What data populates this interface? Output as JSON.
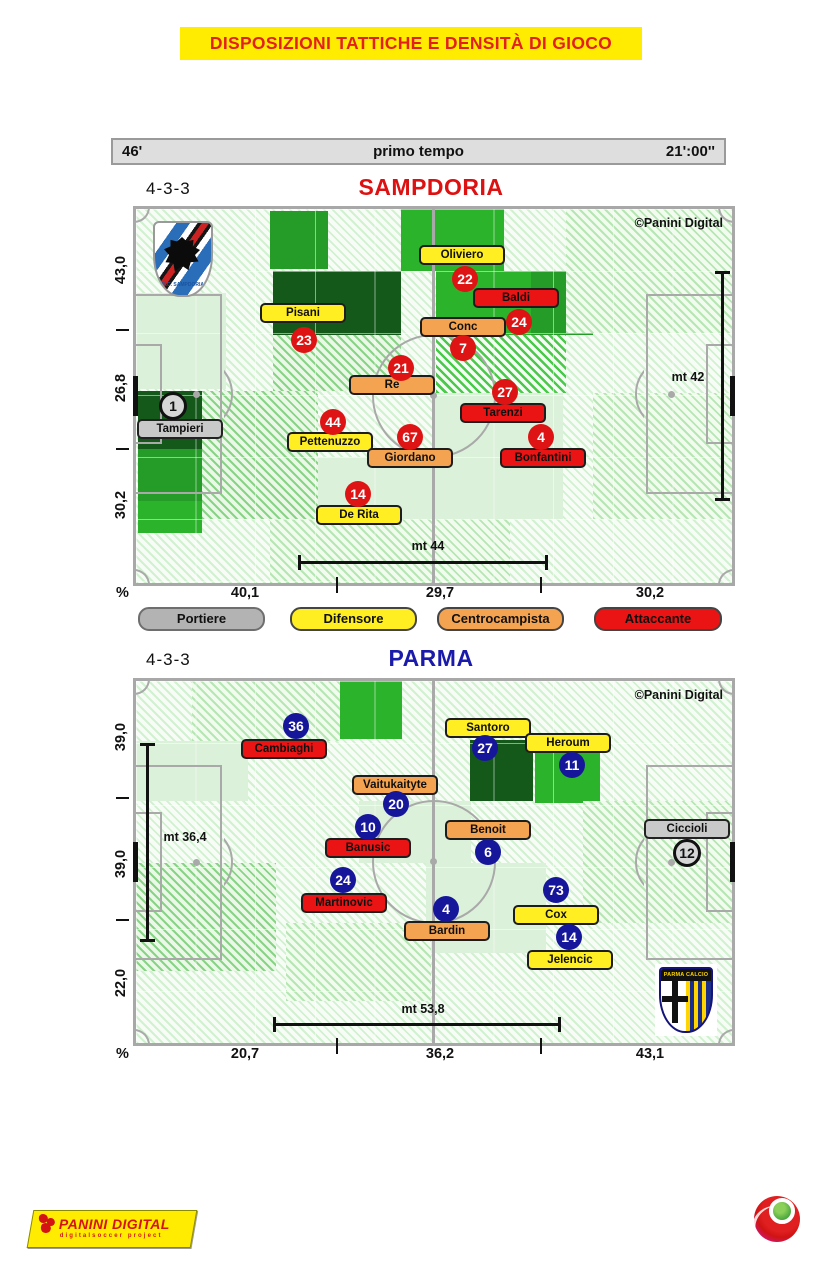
{
  "banner": {
    "title": "DISPOSIZIONI TATTICHE E DENSITÀ DI GIOCO"
  },
  "timebar": {
    "minute": "46'",
    "period": "primo tempo",
    "time": "21':00''"
  },
  "legend": {
    "items": [
      {
        "label": "Portiere",
        "color": "#c9c9c9"
      },
      {
        "label": "Difensore",
        "color": "#ffee22"
      },
      {
        "label": "Centrocampista",
        "color": "#f4a351"
      },
      {
        "label": "Attaccante",
        "color": "#ea1414"
      }
    ]
  },
  "footer": {
    "panini_title": "PANINI DIGITAL",
    "panini_subtitle": "digitalsoccer project"
  },
  "colors": {
    "banner_bg": "#ffec00",
    "banner_text": "#e32020",
    "sampdoria_title": "#dd1111",
    "parma_title": "#1b1bab",
    "samp_number_circle": "#de1414",
    "parma_number_circle": "#16169b",
    "goalkeeper": "#c9c9c9",
    "defender": "#ffee22",
    "midfielder": "#f4a351",
    "forward": "#ea1414"
  },
  "chart_data": {
    "type": "heatmap",
    "subtype": "tactical-disposition-pitch-maps",
    "title": "DISPOSIZIONI TATTICHE E DENSITÀ DI GIOCO",
    "period": "primo tempo",
    "minute": "46'",
    "clock": "21':00''",
    "legend_roles": [
      "Portiere",
      "Difensore",
      "Centrocampista",
      "Attaccante"
    ],
    "teams": [
      {
        "title": "SAMPDORIA",
        "formation": "4-3-3",
        "copyright": "©Panini Digital",
        "crest_text": "U.C. SAMPDORIA",
        "percent_sign": "%",
        "axis_bottom": [
          "40,1",
          "29,7",
          "30,2"
        ],
        "axis_left": [
          "43,0",
          "26,8",
          "30,2"
        ],
        "zones_pct": [
          40.1,
          29.7,
          30.2
        ],
        "vertical_pct": [
          43.0,
          26.8,
          30.2
        ],
        "measure_bottom": "mt 44",
        "measure_side": "mt 42",
        "width_m": 44.0,
        "depth_m": 42.0,
        "players": [
          {
            "name": "Tampieri",
            "number": 1,
            "role": "gk",
            "x": 44,
            "y": 220,
            "nx": 37,
            "ny": 197
          },
          {
            "name": "Oliviero",
            "number": 22,
            "role": "def",
            "x": 326,
            "y": 46,
            "nx": 329,
            "ny": 70
          },
          {
            "name": "Pisani",
            "number": 23,
            "role": "def",
            "x": 167,
            "y": 104,
            "nx": 168,
            "ny": 131
          },
          {
            "name": "Pettenuzzo",
            "number": 44,
            "role": "def",
            "x": 194,
            "y": 233,
            "nx": 197,
            "ny": 213
          },
          {
            "name": "De Rita",
            "number": 14,
            "role": "def",
            "x": 223,
            "y": 306,
            "nx": 222,
            "ny": 285
          },
          {
            "name": "Conc",
            "number": 7,
            "role": "mid",
            "x": 327,
            "y": 118,
            "nx": 327,
            "ny": 139
          },
          {
            "name": "Re",
            "number": 21,
            "role": "mid",
            "x": 256,
            "y": 176,
            "nx": 265,
            "ny": 159
          },
          {
            "name": "Giordano",
            "number": 67,
            "role": "mid",
            "x": 274,
            "y": 249,
            "nx": 274,
            "ny": 228
          },
          {
            "name": "Baldi",
            "number": 24,
            "role": "fwd",
            "x": 380,
            "y": 89,
            "nx": 383,
            "ny": 113
          },
          {
            "name": "Tarenzi",
            "number": 27,
            "role": "fwd",
            "x": 367,
            "y": 204,
            "nx": 369,
            "ny": 183
          },
          {
            "name": "Bonfantini",
            "number": 4,
            "role": "fwd",
            "x": 407,
            "y": 249,
            "nx": 405,
            "ny": 228
          }
        ],
        "density": [
          {
            "x": 134,
            "y": 2,
            "w": 58,
            "h": 58,
            "level": "3"
          },
          {
            "x": 265,
            "y": 0,
            "w": 103,
            "h": 62,
            "level": "4"
          },
          {
            "x": 300,
            "y": 62,
            "w": 97,
            "h": 64,
            "level": "4"
          },
          {
            "x": 395,
            "y": 62,
            "w": 62,
            "h": 64,
            "level": "3"
          },
          {
            "x": 137,
            "y": 62,
            "w": 128,
            "h": 64,
            "level": "5"
          },
          {
            "x": 300,
            "y": 126,
            "w": 130,
            "h": 58,
            "level": "4h"
          },
          {
            "x": 2,
            "y": 182,
            "w": 64,
            "h": 58,
            "level": "5"
          },
          {
            "x": 2,
            "y": 240,
            "w": 64,
            "h": 52,
            "level": "3"
          },
          {
            "x": 2,
            "y": 292,
            "w": 64,
            "h": 32,
            "level": "4"
          },
          {
            "x": 0,
            "y": 84,
            "w": 90,
            "h": 96,
            "level": "1"
          },
          {
            "x": 297,
            "y": 184,
            "w": 130,
            "h": 126,
            "level": "1"
          },
          {
            "x": 160,
            "y": 248,
            "w": 137,
            "h": 62,
            "level": "1"
          },
          {
            "x": 137,
            "y": 126,
            "w": 128,
            "h": 56,
            "level": "2h"
          },
          {
            "x": 66,
            "y": 182,
            "w": 116,
            "h": 128,
            "level": "2h"
          },
          {
            "x": 430,
            "y": 0,
            "w": 166,
            "h": 124,
            "level": "1h"
          },
          {
            "x": 457,
            "y": 184,
            "w": 139,
            "h": 126,
            "level": "1h"
          },
          {
            "x": 134,
            "y": 310,
            "w": 240,
            "h": 64,
            "level": "1h"
          }
        ]
      },
      {
        "title": "PARMA",
        "formation": "4-3-3",
        "copyright": "©Panini Digital",
        "crest_text": "PARMA CALCIO",
        "percent_sign": "%",
        "axis_bottom": [
          "20,7",
          "36,2",
          "43,1"
        ],
        "axis_left": [
          "39,0",
          "39,0",
          "22,0"
        ],
        "zones_pct": [
          20.7,
          36.2,
          43.1
        ],
        "vertical_pct": [
          39.0,
          39.0,
          22.0
        ],
        "measure_bottom": "mt 53,8",
        "measure_side": "mt 36,4",
        "width_m": 53.8,
        "depth_m": 36.4,
        "players": [
          {
            "name": "Ciccioli",
            "number": 12,
            "role": "gk",
            "x": 551,
            "y": 148,
            "nx": 551,
            "ny": 172
          },
          {
            "name": "Santoro",
            "number": 27,
            "role": "def",
            "x": 352,
            "y": 47,
            "nx": 349,
            "ny": 67
          },
          {
            "name": "Heroum",
            "number": 11,
            "role": "def",
            "x": 432,
            "y": 62,
            "nx": 436,
            "ny": 84
          },
          {
            "name": "Cox",
            "number": 73,
            "role": "def",
            "x": 420,
            "y": 234,
            "nx": 420,
            "ny": 209
          },
          {
            "name": "Jelencic",
            "number": 14,
            "role": "def",
            "x": 434,
            "y": 279,
            "nx": 433,
            "ny": 256
          },
          {
            "name": "Vaitukaityte",
            "number": 20,
            "role": "mid",
            "x": 259,
            "y": 104,
            "nx": 260,
            "ny": 123
          },
          {
            "name": "Benoit",
            "number": 6,
            "role": "mid",
            "x": 352,
            "y": 149,
            "nx": 352,
            "ny": 171
          },
          {
            "name": "Bardin",
            "number": 4,
            "role": "mid",
            "x": 311,
            "y": 250,
            "nx": 310,
            "ny": 228
          },
          {
            "name": "Cambiaghi",
            "number": 36,
            "role": "fwd",
            "x": 148,
            "y": 68,
            "nx": 160,
            "ny": 45
          },
          {
            "name": "Banusic",
            "number": 10,
            "role": "fwd",
            "x": 232,
            "y": 167,
            "nx": 232,
            "ny": 146
          },
          {
            "name": "Martinovic",
            "number": 24,
            "role": "fwd",
            "x": 208,
            "y": 222,
            "nx": 207,
            "ny": 199
          }
        ],
        "density": [
          {
            "x": 204,
            "y": 0,
            "w": 62,
            "h": 58,
            "level": "4"
          },
          {
            "x": 334,
            "y": 59,
            "w": 63,
            "h": 61,
            "level": "5"
          },
          {
            "x": 399,
            "y": 66,
            "w": 65,
            "h": 56,
            "level": "4"
          },
          {
            "x": 0,
            "y": 60,
            "w": 112,
            "h": 60,
            "level": "1"
          },
          {
            "x": 223,
            "y": 120,
            "w": 112,
            "h": 62,
            "level": "1"
          },
          {
            "x": 0,
            "y": 182,
            "w": 140,
            "h": 108,
            "level": "2h"
          },
          {
            "x": 447,
            "y": 120,
            "w": 149,
            "h": 122,
            "level": "1h"
          },
          {
            "x": 290,
            "y": 182,
            "w": 120,
            "h": 90,
            "level": "1"
          },
          {
            "x": 56,
            "y": 0,
            "w": 148,
            "h": 60,
            "level": "1h"
          },
          {
            "x": 150,
            "y": 242,
            "w": 145,
            "h": 78,
            "level": "1h"
          }
        ]
      }
    ]
  }
}
